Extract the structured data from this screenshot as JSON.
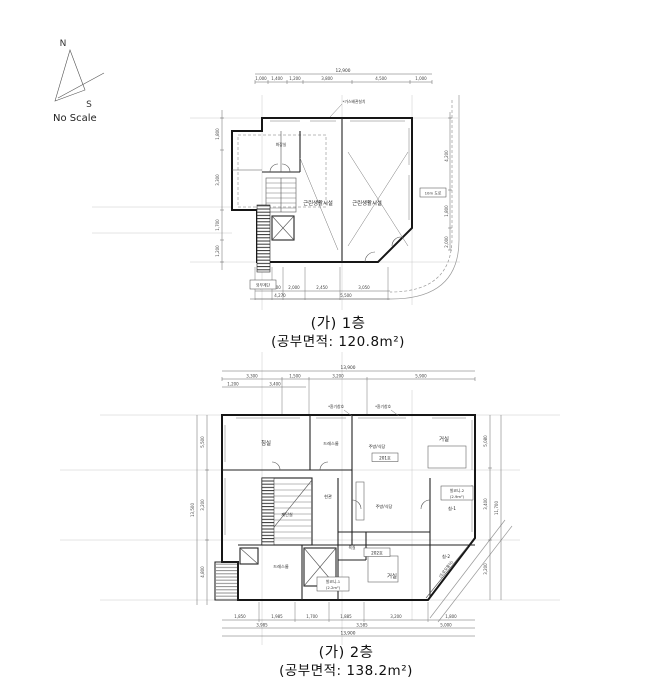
{
  "compass": {
    "north": "N",
    "south": "S",
    "no_scale": "No Scale"
  },
  "floor1": {
    "caption1": "(가) 1층",
    "caption2": "(공부면적: 120.8m²)",
    "rooms": {
      "retail_left": "근린생활시설",
      "retail_right": "근린생활시설",
      "wc": "화장실"
    },
    "labels": {
      "road": "10m 도로",
      "gas_note": "*가스배관설치",
      "ext_stair": "외부계단"
    },
    "dims": {
      "top_total": "12,900",
      "top": [
        "1,000",
        "1,400",
        "1,200",
        "3,800",
        "4,500",
        "1,000"
      ],
      "left": [
        "1,800",
        "3,300",
        "1,700",
        "1,200"
      ],
      "right": [
        "4,200",
        "1,800",
        "2,000"
      ],
      "bottom1": [
        "1,370",
        "900",
        "2,000",
        "2,450",
        "3,050"
      ],
      "bottom2": [
        "4,270",
        "5,500"
      ]
    }
  },
  "floor2": {
    "caption1": "(가) 2층",
    "caption2": "(공부면적: 138.2m²)",
    "rooms": {
      "bed1": "침실",
      "dress1": "드레스룸",
      "kitchen1": "주방/식당",
      "unit1": "201호",
      "living1": "거실",
      "stair": "계단실",
      "entry": "현관",
      "kitchen2": "주방/식당",
      "bed2a": "침-1",
      "bed2b": "침-2",
      "bath": "욕실",
      "unit2": "202호",
      "living2": "거실",
      "dress2": "드레스룸"
    },
    "labels": {
      "balcony1": "발코니-1",
      "balcony1_area": "(2.2m²)",
      "balcony2": "발코니-2",
      "balcony2_area": "(2.9m²)",
      "corner": "(도로모퉁이)",
      "vent1": "*환기창호",
      "vent2": "*환기창호"
    },
    "dims": {
      "top_total": "13,900",
      "top": [
        "3,300",
        "1,500",
        "3,200",
        "5,900"
      ],
      "top_sub": [
        "1,200",
        "3,400"
      ],
      "left": [
        "5,500",
        "3,200",
        "4,800"
      ],
      "left_total": "13,500",
      "right": [
        "5,080",
        "3,400",
        "3,200"
      ],
      "right_total": "11,700",
      "bottom1": [
        "1,850",
        "1,985",
        "1,700",
        "1,885",
        "3,200",
        "1,800"
      ],
      "bottom2": [
        "3,985",
        "3,585",
        "5,000"
      ],
      "bottom_total": "13,900"
    }
  }
}
